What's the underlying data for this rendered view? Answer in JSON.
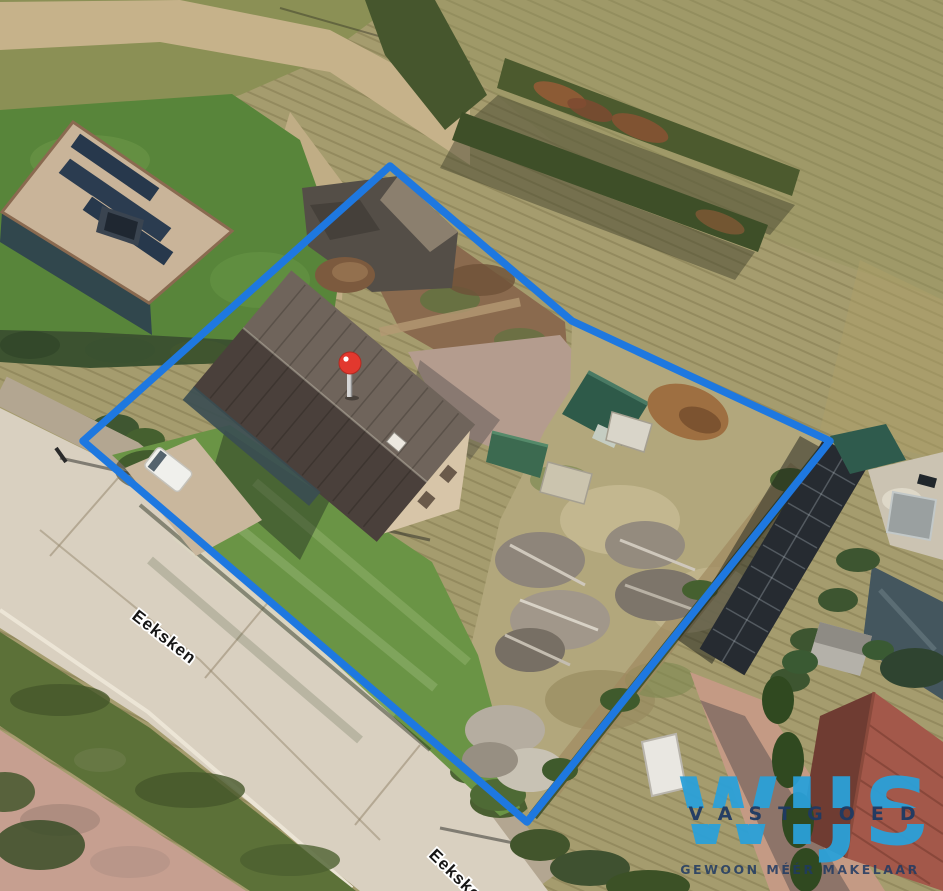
{
  "map": {
    "street_labels": [
      "Eeksken",
      "Eeksken"
    ],
    "marker": {
      "shape": "red-pushpin",
      "color": "#e2382e"
    },
    "boundary": {
      "color": "#1e78e0",
      "points": "390,166 572,321 830,441 527,822 83,441"
    }
  },
  "watermark": {
    "brand": "WIJS",
    "subtitle": "VASTGOED",
    "tagline": "GEWOON MÉÉR MAKELAAR",
    "brand_color": "#2aa0d8",
    "subtitle_color": "#1e3a63"
  }
}
